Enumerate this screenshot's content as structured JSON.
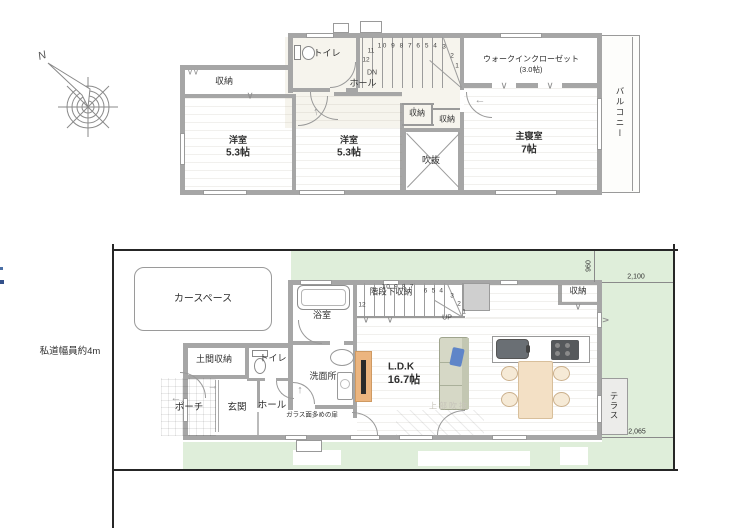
{
  "compass": {
    "north": "N"
  },
  "floor2": {
    "toilet": "トイレ",
    "hall": "ホール",
    "storage": "収納",
    "wic_line1": "ウォークインクローゼット",
    "wic_line2": "(3.0帖)",
    "bedroom1_name": "洋室",
    "bedroom1_size": "5.3帖",
    "bedroom2_name": "洋室",
    "bedroom2_size": "5.3帖",
    "void_label": "吹抜",
    "storage_a": "収納",
    "storage_b": "収納",
    "master_name": "主寝室",
    "master_size": "7帖",
    "balcony": "バルコニー",
    "stairs": {
      "dn": "DN",
      "run": "10 9 8 7 6 5 4",
      "s3": "3",
      "s2": "2",
      "s1": "1",
      "s11": "11",
      "s12": "12"
    }
  },
  "floor1": {
    "road_label": "私道幅員約4m",
    "car_space": "カースペース",
    "bath": "浴室",
    "under_stair_storage": "階段下収納",
    "storage": "収納",
    "ldk_name": "L.D.K",
    "ldk_size": "16.7帖",
    "washroom": "洗面所",
    "toilet": "トイレ",
    "doma_storage": "土間収納",
    "entrance": "玄関",
    "porch": "ポーチ",
    "hall": "ホール",
    "glass_door_note": "ガラス面多めの扉",
    "upper_void_note": "上部吹抜",
    "terrace": "テラス",
    "stairs": {
      "up": "UP",
      "run": "10 9 8 7",
      "mid": "6 5 4",
      "s3": "3",
      "s2": "2",
      "s1": "1",
      "s12": "12"
    },
    "dims": {
      "d960": "960",
      "d2100": "2,100",
      "d2065": "2,065"
    }
  }
}
